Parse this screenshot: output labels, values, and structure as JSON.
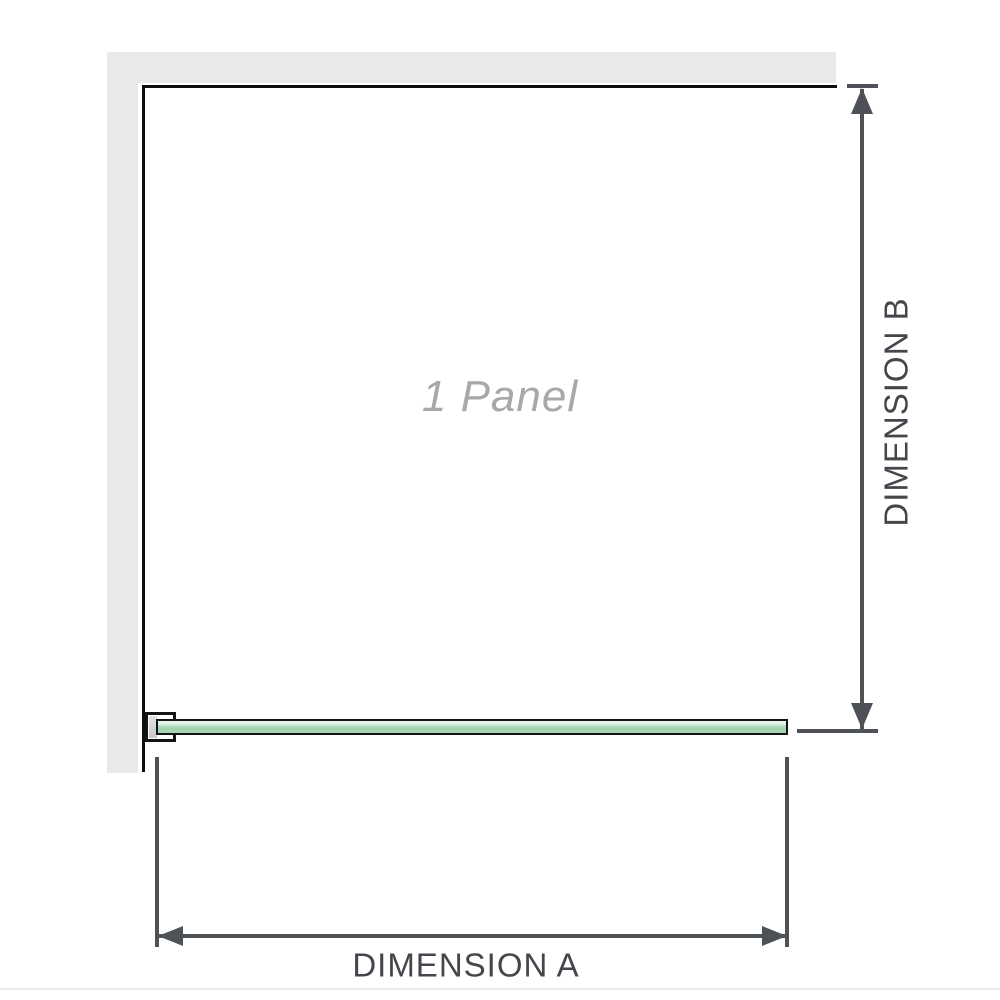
{
  "panel": {
    "label": "1 Panel"
  },
  "dimensions": {
    "a": {
      "label": "DIMENSION A"
    },
    "b": {
      "label": "DIMENSION B"
    }
  },
  "icons": {
    "arrow_up": "filled-triangle-up",
    "arrow_down": "filled-triangle-down",
    "arrow_left": "filled-triangle-left",
    "arrow_right": "filled-triangle-right"
  },
  "colors": {
    "wall": "#e9e9e9",
    "panel_outline": "#0d0d0d",
    "dimension_lines": "#4e5257",
    "dimension_text": "#43474c",
    "glass_green": "#9fd2ae",
    "glass_highlight": "#eef8f0",
    "panel_label_gray": "#a8a8a8",
    "bracket_pad": "#d2d2d2",
    "footer_rule": "#edeae6"
  }
}
